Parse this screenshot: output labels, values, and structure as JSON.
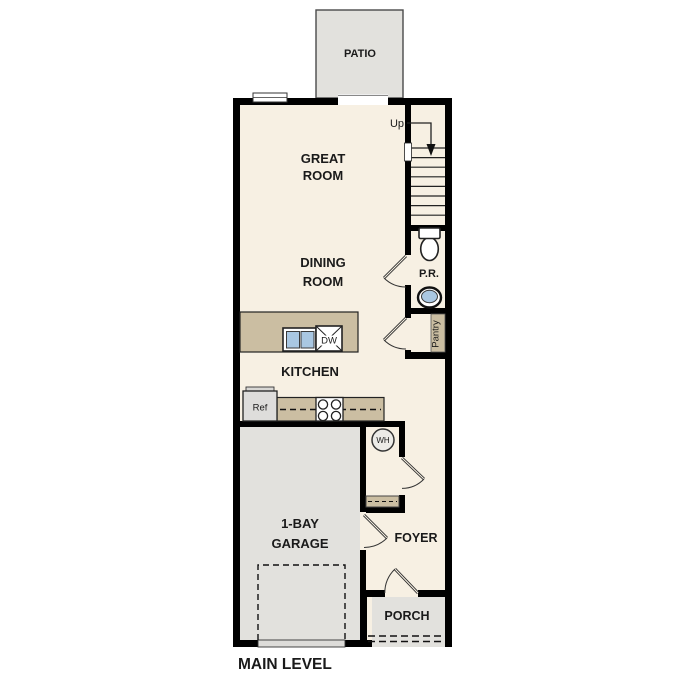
{
  "plan_title": "MAIN LEVEL",
  "rooms": {
    "patio": "PATIO",
    "great_room_line1": "GREAT",
    "great_room_line2": "ROOM",
    "dining_line1": "DINING",
    "dining_line2": "ROOM",
    "kitchen": "KITCHEN",
    "garage_line1": "1-BAY",
    "garage_line2": "GARAGE",
    "foyer": "FOYER",
    "porch": "PORCH",
    "powder_room": "P.R.",
    "pantry": "Pantry"
  },
  "fixtures": {
    "dishwasher": "DW",
    "refrigerator": "Ref",
    "water_heater": "WH"
  },
  "stairs": {
    "direction_label": "Up"
  },
  "colors": {
    "wall": "#000000",
    "interior_floor": "#f7f0e3",
    "hardscape": "#e2e1dd",
    "casework_tan": "#cbbea2",
    "water_blue": "#a9c7e2"
  }
}
